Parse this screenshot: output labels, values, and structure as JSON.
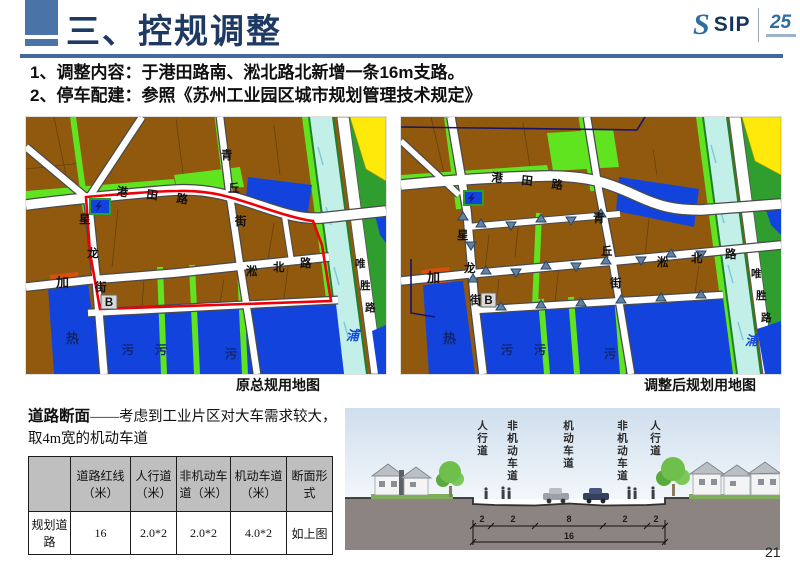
{
  "header": {
    "title": "三、控规调整",
    "logo": {
      "glyph": "S",
      "text": "SIP",
      "anniversary": "25"
    }
  },
  "bullets": [
    "1、调整内容：于港田路南、淞北路北新增一条16m支路。",
    "2、停车配建：参照《苏州工业园区城市规划管理技术规定》"
  ],
  "map_labels": {
    "gangtian": [
      "港",
      "田",
      "路"
    ],
    "qingqiu": [
      "青",
      "丘",
      "街"
    ],
    "xinglong": [
      "星",
      "龙",
      "街"
    ],
    "songbei": [
      "淞",
      "北",
      "路"
    ],
    "weisheng": [
      "唯",
      "胜",
      "路"
    ],
    "jia": "加",
    "b_marker": "B",
    "re": "热",
    "wu": "污",
    "pu": "浦"
  },
  "maps": {
    "left": {
      "caption": "原总规用地图"
    },
    "right": {
      "caption": "调整后规划用地图"
    }
  },
  "road_section": {
    "heading": "道路断面",
    "note": "——考虑到工业片区对大车需求较大，取4m宽的机动车道",
    "table": {
      "headers": [
        "",
        "道路红线（米）",
        "人行道（米）",
        "非机动车道（米）",
        "机动车道（米）",
        "断面形式"
      ],
      "cells": [
        "规划道路",
        "16",
        "2.0*2",
        "2.0*2",
        "4.0*2",
        "如上图"
      ]
    }
  },
  "cross_section": {
    "lane_labels": [
      "人行道",
      "非机动车道",
      "机动车道",
      "非机动车道",
      "人行道"
    ],
    "dims": [
      "2",
      "2",
      "8",
      "2",
      "2"
    ],
    "total": "16"
  },
  "page_number": "21"
}
